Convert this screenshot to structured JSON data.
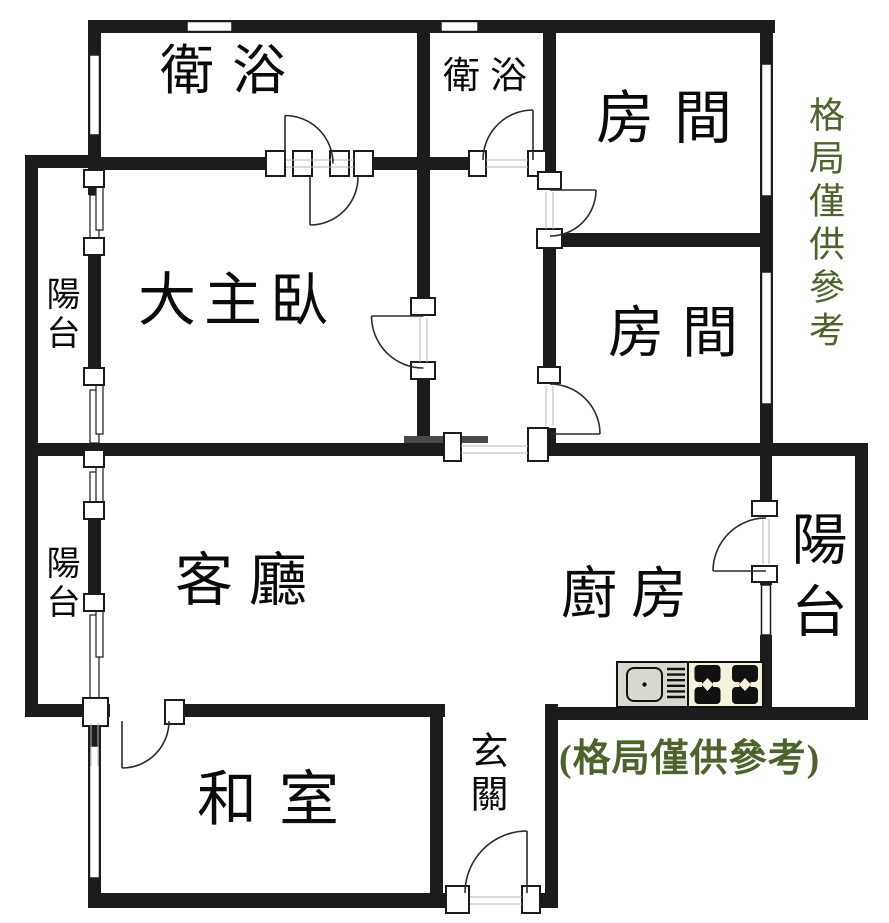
{
  "rooms": {
    "bathroom_main": {
      "label": "衛浴"
    },
    "bathroom_small": {
      "label": "衛浴"
    },
    "bedroom_top": {
      "label": "房間"
    },
    "bedroom_mid": {
      "label": "房間"
    },
    "master_bedroom": {
      "label": "大主臥"
    },
    "living_room": {
      "label": "客廳"
    },
    "kitchen": {
      "label": "廚房"
    },
    "tatami_room": {
      "label": "和室"
    },
    "entryway": {
      "label": "玄關"
    },
    "balcony_upper_left": {
      "label": "陽台"
    },
    "balcony_lower_left": {
      "label": "陽台"
    },
    "balcony_right": {
      "label": "陽台"
    }
  },
  "annotations": {
    "side_note_vertical": "格局僅供參考",
    "bottom_note": "(格局僅供參考)"
  },
  "colors": {
    "wall": "#1c1c1c",
    "note_green": "#4d632b",
    "counter_gray": "#d9d8cf",
    "stove_cream": "#f4f2dd"
  }
}
